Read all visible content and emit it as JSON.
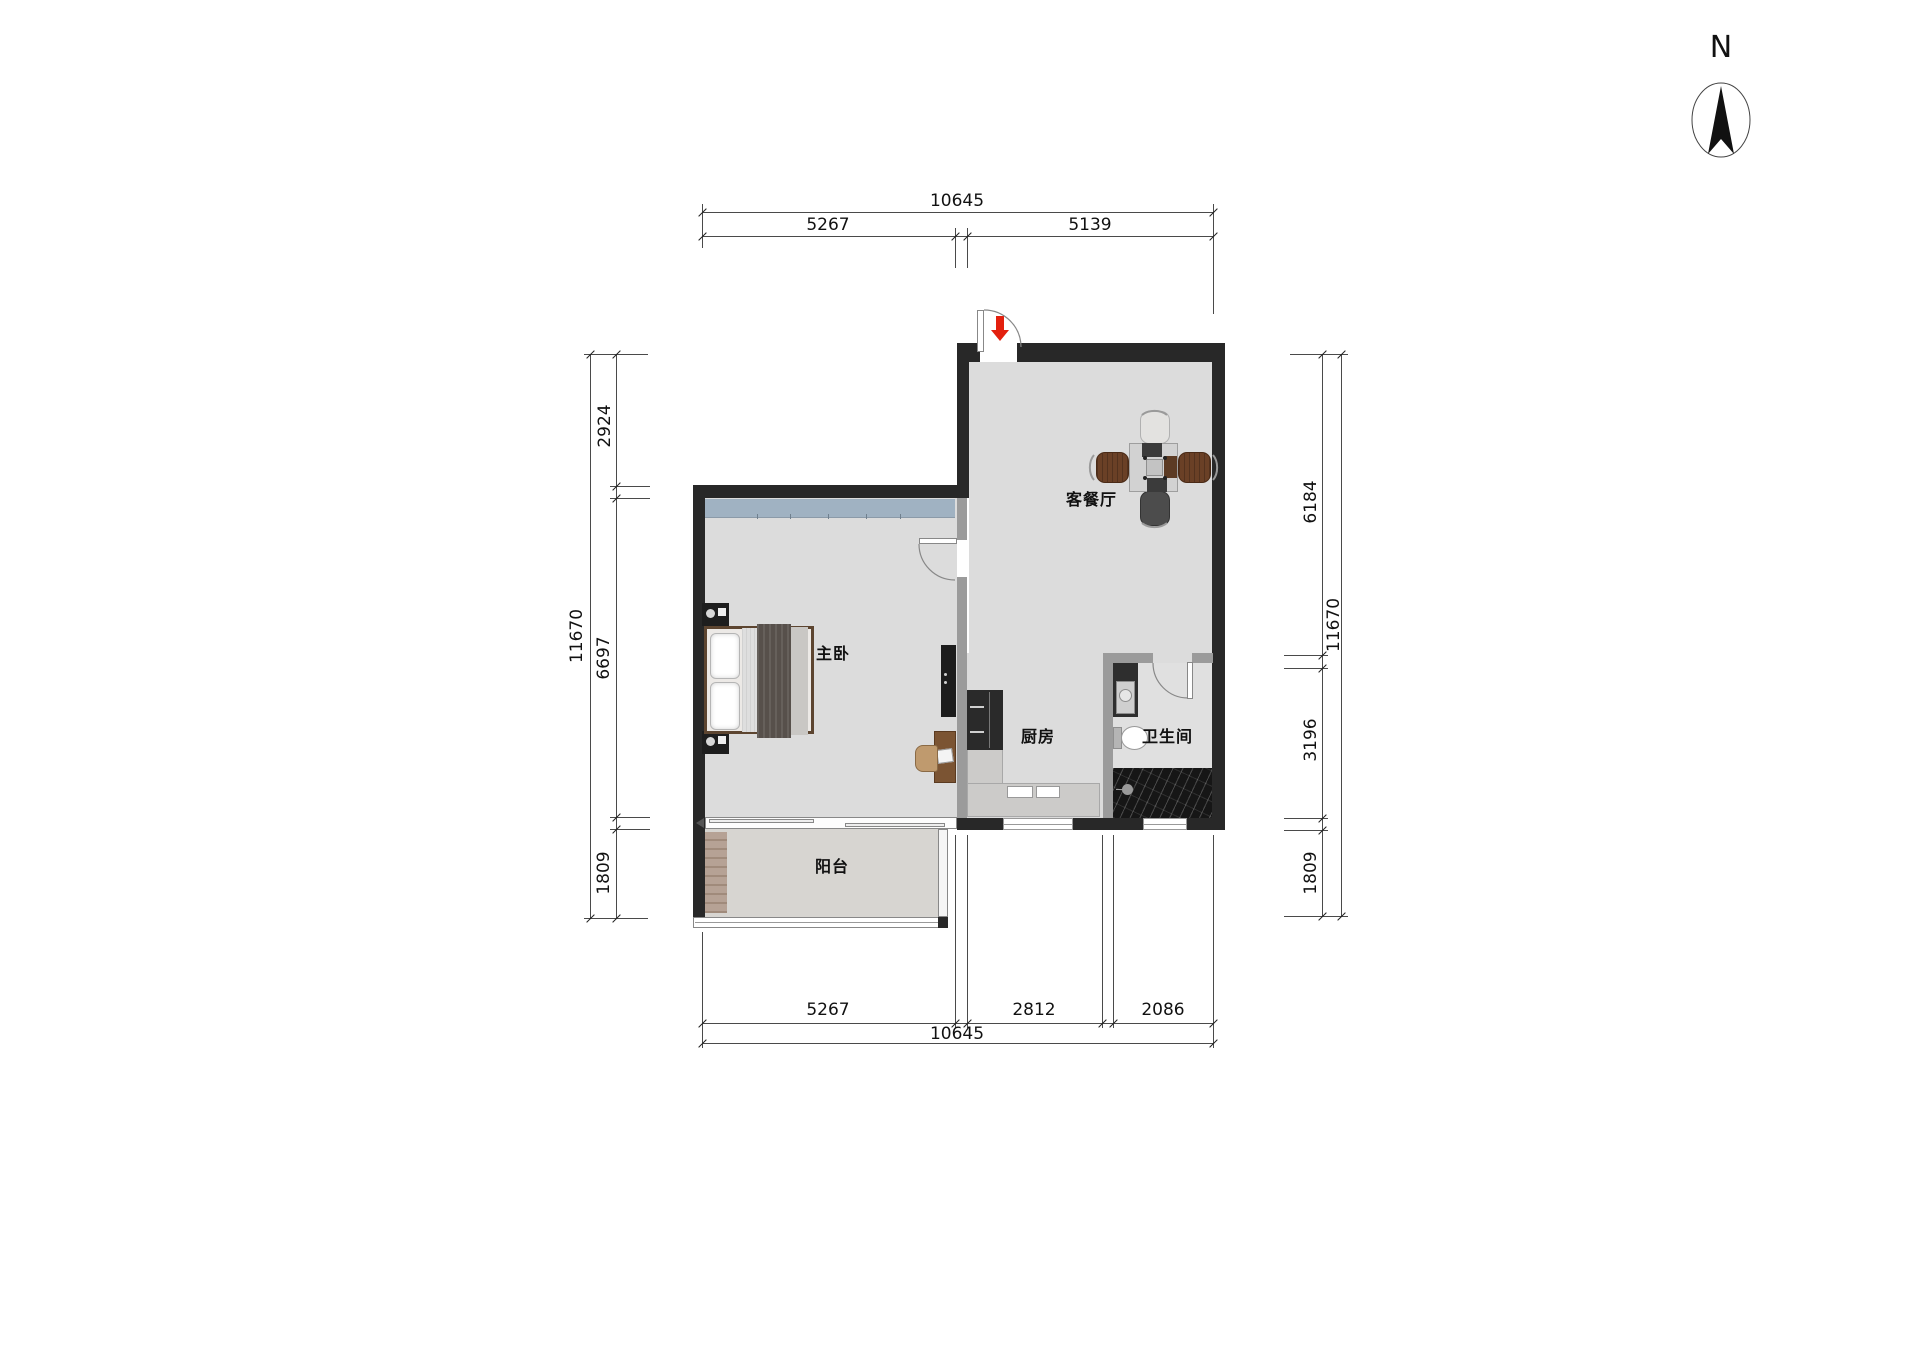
{
  "compass": {
    "label": "N"
  },
  "rooms": {
    "living": {
      "label": "客餐厅"
    },
    "bedroom": {
      "label": "主卧"
    },
    "kitchen": {
      "label": "厨房"
    },
    "bathroom": {
      "label": "卫生间"
    },
    "balcony": {
      "label": "阳台"
    }
  },
  "dimensions": {
    "top": {
      "total": "10645",
      "seg1": "5267",
      "seg2": "5139"
    },
    "bottom": {
      "total": "10645",
      "seg1": "5267",
      "seg2": "2812",
      "seg3": "2086"
    },
    "left": {
      "total": "11670",
      "seg1": "2924",
      "seg2": "6697",
      "seg3": "1809"
    },
    "right": {
      "total": "11670",
      "seg1": "6184",
      "seg2": "3196",
      "seg3": "1809"
    }
  },
  "colors": {
    "wall": "#282828",
    "interior_wall": "#9b9b9b",
    "floor": "#dcdcdc",
    "window_band": "#a0b2c2",
    "entry_arrow_red": "#e3200e",
    "wood": "#7b5433"
  }
}
